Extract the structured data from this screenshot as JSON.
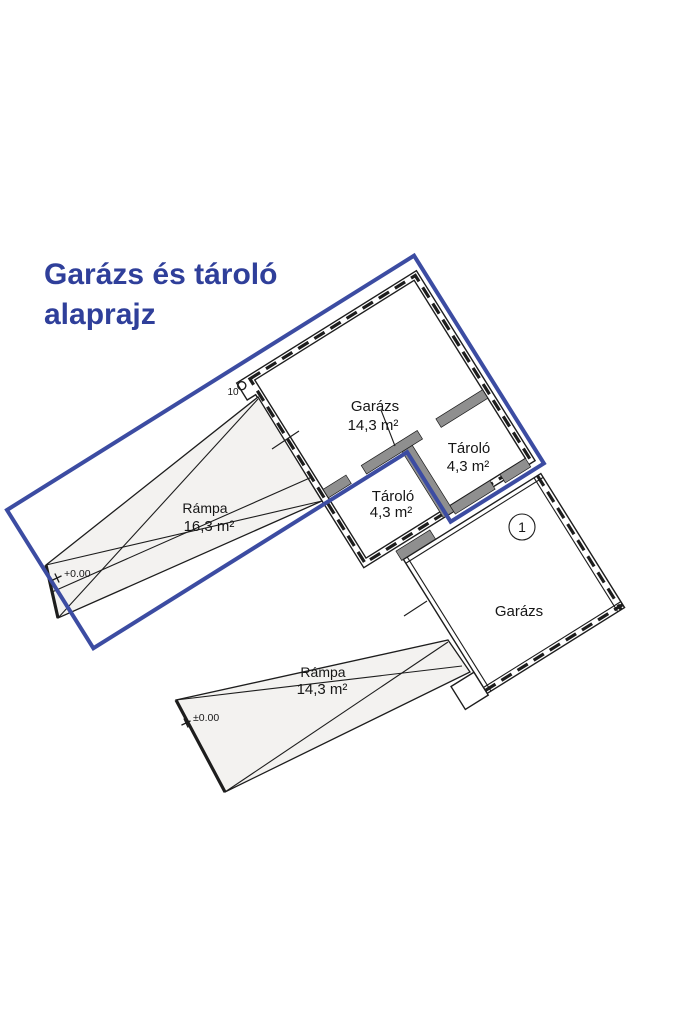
{
  "title": {
    "line1": "Garázs és tároló",
    "line2": "alaprajz"
  },
  "rooms": {
    "garage_upper": {
      "name": "Garázs",
      "area": "14,3 m²"
    },
    "storage_right": {
      "name": "Tároló",
      "area": "4,3 m²"
    },
    "storage_left": {
      "name": "Tároló",
      "area": "4,3 m²"
    },
    "ramp_upper": {
      "name": "Rámpa",
      "area": "16,3 m²"
    },
    "ramp_lower": {
      "name": "Rámpa",
      "area": "14,3 m²"
    },
    "garage_lower": {
      "name": "Garázs"
    }
  },
  "annotations": {
    "unit_number": "1",
    "wall_dim": "10",
    "level_mark_upper": "+0.00",
    "level_mark_lower": "±0.00"
  },
  "colors": {
    "highlight_blue": "#3c4ca2",
    "title_blue": "#2f3f9a",
    "line_black": "#1d1d1d",
    "wall_gray": "#8f8f8f",
    "ramp_fill": "#f3f2f0"
  }
}
